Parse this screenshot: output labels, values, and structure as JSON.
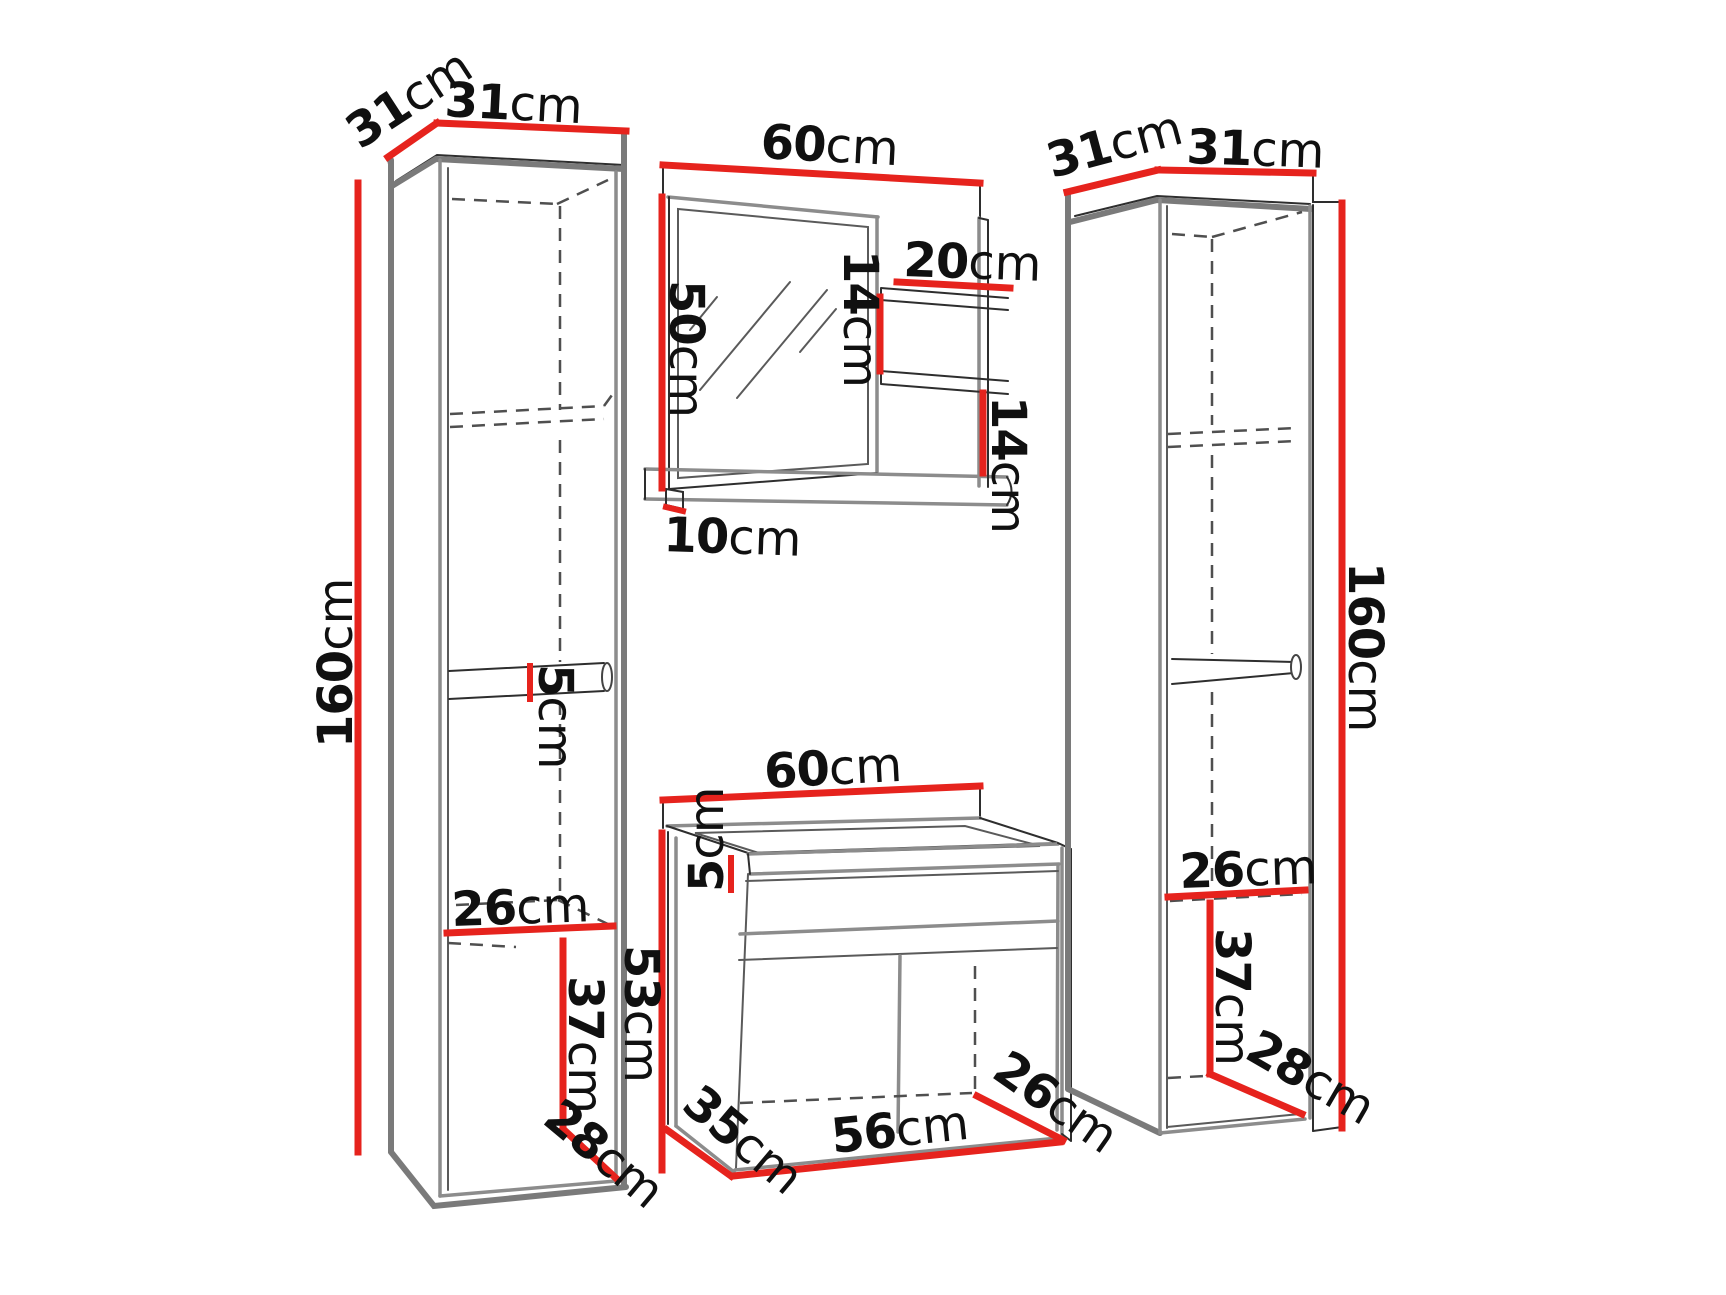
{
  "diagram": {
    "title": "Bathroom furniture set – dimension drawing",
    "colors": {
      "dimension_red": "#e6231d",
      "line_gray": "#7a7a7a",
      "line_dark": "#2e2e2e",
      "dash_gray": "#4f4f4f",
      "background": "#ffffff",
      "text": "#101010"
    },
    "left_cabinet": {
      "name": "left tall cabinet",
      "depth": {
        "num": "31",
        "unit": "cm"
      },
      "width": {
        "num": "31",
        "unit": "cm"
      },
      "height": {
        "num": "160",
        "unit": "cm"
      },
      "shelf_thickness": {
        "num": "5",
        "unit": "cm"
      },
      "inner_width": {
        "num": "26",
        "unit": "cm"
      },
      "door_height": {
        "num": "37",
        "unit": "cm"
      },
      "inner_depth": {
        "num": "28",
        "unit": "cm"
      }
    },
    "mirror_unit": {
      "name": "mirror with side shelves",
      "width": {
        "num": "60",
        "unit": "cm"
      },
      "height": {
        "num": "50",
        "unit": "cm"
      },
      "side_shelf_width": {
        "num": "20",
        "unit": "cm"
      },
      "upper_shelf_gap": {
        "num": "14",
        "unit": "cm"
      },
      "lower_shelf_gap": {
        "num": "14",
        "unit": "cm"
      },
      "bottom_shelf_depth": {
        "num": "10",
        "unit": "cm"
      }
    },
    "vanity": {
      "name": "washbasin cabinet",
      "width": {
        "num": "60",
        "unit": "cm"
      },
      "basin_height": {
        "num": "5",
        "unit": "cm"
      },
      "height": {
        "num": "53",
        "unit": "cm"
      },
      "depth": {
        "num": "35",
        "unit": "cm"
      },
      "inner_width": {
        "num": "56",
        "unit": "cm"
      },
      "inner_depth": {
        "num": "26",
        "unit": "cm"
      }
    },
    "right_cabinet": {
      "name": "right tall cabinet",
      "depth": {
        "num": "31",
        "unit": "cm"
      },
      "width": {
        "num": "31",
        "unit": "cm"
      },
      "height": {
        "num": "160",
        "unit": "cm"
      },
      "inner_width": {
        "num": "26",
        "unit": "cm"
      },
      "door_height": {
        "num": "37",
        "unit": "cm"
      },
      "inner_depth": {
        "num": "28",
        "unit": "cm"
      }
    }
  }
}
